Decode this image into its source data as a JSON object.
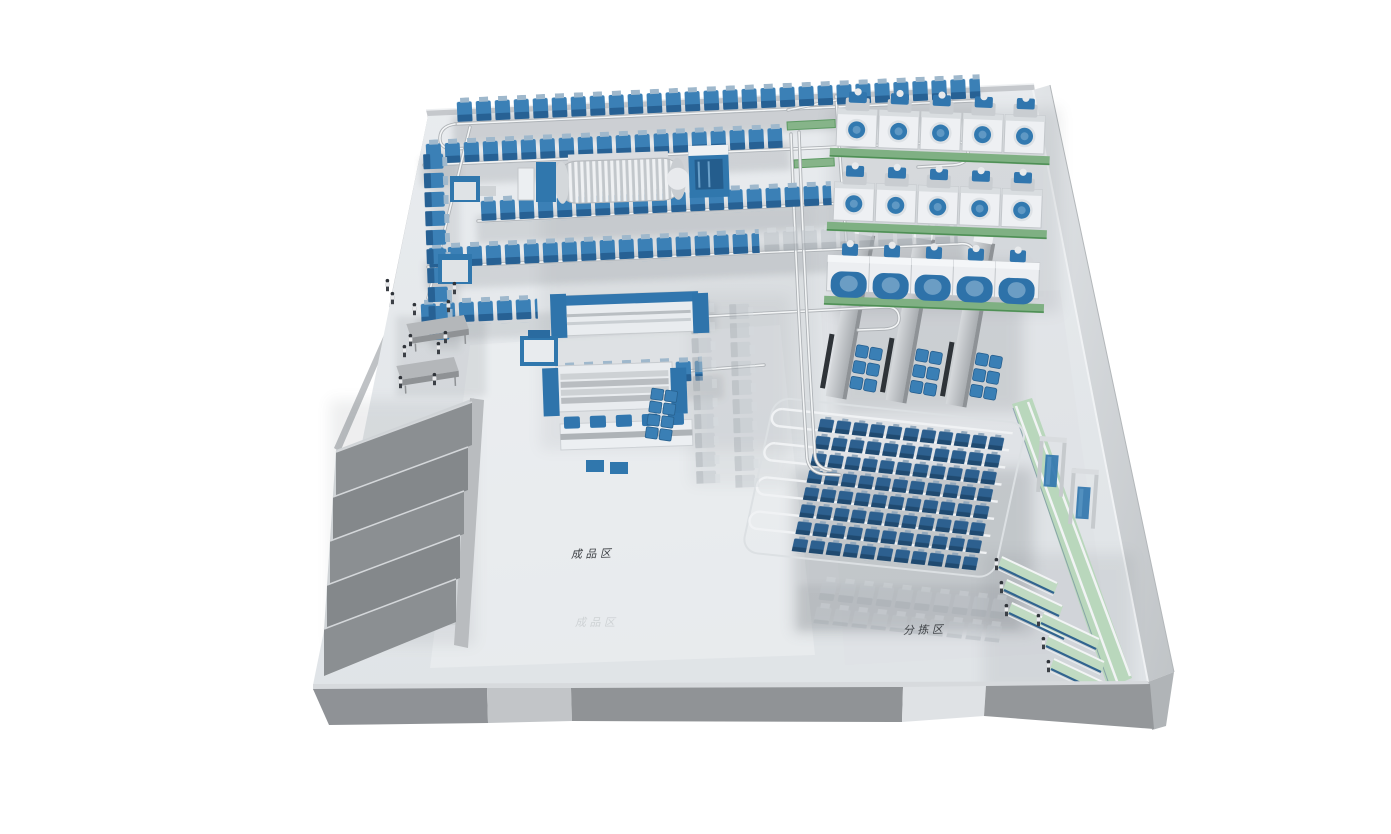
{
  "scene": {
    "type": "3d-laundry-factory-layout-render",
    "background": "#ffffff",
    "labels": {
      "finished_goods_area": "成品区",
      "sorting_area": "分拣区",
      "finished_goods_area_faint": "成品区"
    },
    "palette": {
      "machine_blue": "#3077ad",
      "bag_blue": "#3b80b6",
      "storage_bag_blue": "#2d608f",
      "conveyor_green": "#bcd8be",
      "belt_green": "#86b489",
      "floor_gray": "#e5e8eb",
      "wall_gray": "#909396",
      "metal_light": "#eceff2",
      "shadow_gray": "#60666c"
    },
    "counts": {
      "washer_grid_rows": 3,
      "washer_grid_columns": 5,
      "washer_machines_total": 15,
      "sorting_conveyors": 6,
      "dock_bays": 5,
      "finishing_lines": 3,
      "work_tables": 2,
      "workers_visible": 17
    }
  }
}
